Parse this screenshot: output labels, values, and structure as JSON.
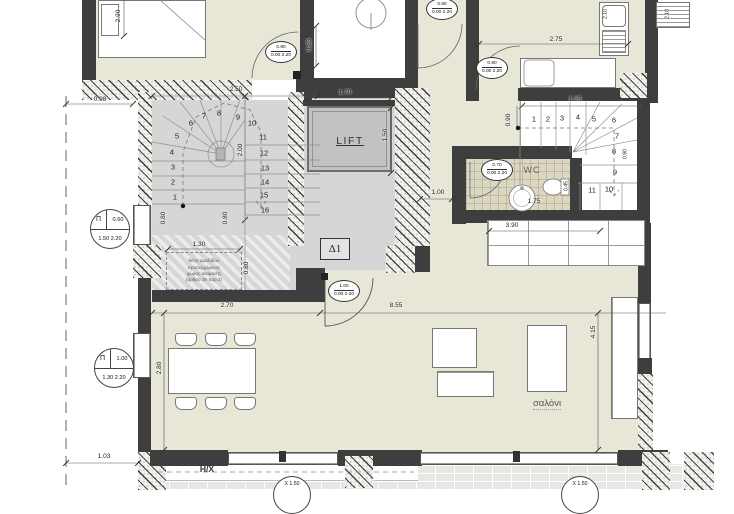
{
  "labels": {
    "lift": "LIFT",
    "wc": "WC",
    "living": "σαλόνι",
    "d1": "Δ1",
    "hx": "Η/Χ",
    "bedroom_partial": "υπνοδωμάτιο"
  },
  "notes": [
    "θέση αμαξιδίου",
    "προσερχόμενος",
    "χώρος αναμονής",
    "(άρθρο 26 παρ.2)"
  ],
  "dims": [
    {
      "t": "0.98",
      "x": 100,
      "y": 100
    },
    {
      "t": "2.90",
      "x": 119,
      "y": 16,
      "r": 1
    },
    {
      "t": "2.50",
      "x": 236,
      "y": 90
    },
    {
      "t": "2.00",
      "x": 241,
      "y": 150,
      "r": 1
    },
    {
      "t": "0.80",
      "x": 164,
      "y": 218,
      "r": 1
    },
    {
      "t": "0.80",
      "x": 226,
      "y": 218,
      "r": 1
    },
    {
      "t": "1.30",
      "x": 199,
      "y": 245
    },
    {
      "t": "0.80",
      "x": 247,
      "y": 268,
      "r": 1
    },
    {
      "t": "1.70",
      "x": 345,
      "y": 93
    },
    {
      "t": "1.50",
      "x": 386,
      "y": 135,
      "r": 1
    },
    {
      "t": "0.85",
      "x": 310,
      "y": 45,
      "r": 1
    },
    {
      "t": "2.75",
      "x": 556,
      "y": 40
    },
    {
      "t": "2.10",
      "x": 606,
      "y": 14,
      "r": 1,
      "s": 1
    },
    {
      "t": "2.10",
      "x": 668,
      "y": 14,
      "r": 1,
      "s": 1
    },
    {
      "t": "1.95",
      "x": 575,
      "y": 100
    },
    {
      "t": "0.90",
      "x": 509,
      "y": 120,
      "r": 1
    },
    {
      "t": "0.90",
      "x": 626,
      "y": 154,
      "r": 1,
      "s": 1
    },
    {
      "t": "1.00",
      "x": 438,
      "y": 193
    },
    {
      "t": "1.75",
      "x": 534,
      "y": 202
    },
    {
      "t": "0.45",
      "x": 567,
      "y": 186,
      "r": 1,
      "s": 1
    },
    {
      "t": "3.90",
      "x": 512,
      "y": 226
    },
    {
      "t": "2.70",
      "x": 227,
      "y": 306
    },
    {
      "t": "8.55",
      "x": 396,
      "y": 306
    },
    {
      "t": "2.80",
      "x": 160,
      "y": 368,
      "r": 1
    },
    {
      "t": "4.15",
      "x": 594,
      "y": 332,
      "r": 1
    },
    {
      "t": "1.03",
      "x": 104,
      "y": 457
    }
  ],
  "door_tags": [
    {
      "w": "0.80",
      "b": "0.00 2.20",
      "x": 281,
      "y": 52
    },
    {
      "w": "0.80",
      "b": "0.00 2.20",
      "x": 442,
      "y": 9
    },
    {
      "w": "0.80",
      "b": "0.00 2.20",
      "x": 492,
      "y": 68
    },
    {
      "w": "1.00",
      "b": "0.00 2.20",
      "x": 344,
      "y": 291
    },
    {
      "w": "0.70",
      "b": "0.00 2.20",
      "x": 497,
      "y": 170
    }
  ],
  "window_tags": [
    {
      "sym": "Π",
      "top": "0.60",
      "bottom": "1.50 2.20",
      "x": 110,
      "y": 229
    },
    {
      "sym": "Π",
      "top": "1.00",
      "bottom": "1.30 2.20",
      "x": 114,
      "y": 368
    }
  ],
  "bottom_tags": [
    {
      "t": "Χ 1.50",
      "x": 292,
      "y": 476
    },
    {
      "t": "Χ 1.50",
      "x": 580,
      "y": 476
    }
  ],
  "stairs": {
    "left": [
      {
        "n": "1",
        "x": 175,
        "y": 197
      },
      {
        "n": "2",
        "x": 173,
        "y": 182
      },
      {
        "n": "3",
        "x": 173,
        "y": 167
      },
      {
        "n": "4",
        "x": 172,
        "y": 152
      },
      {
        "n": "5",
        "x": 177,
        "y": 136
      },
      {
        "n": "6",
        "x": 191,
        "y": 123
      },
      {
        "n": "7",
        "x": 204,
        "y": 116
      },
      {
        "n": "8",
        "x": 219,
        "y": 113
      },
      {
        "n": "9",
        "x": 238,
        "y": 117
      },
      {
        "n": "10",
        "x": 252,
        "y": 123
      },
      {
        "n": "11",
        "x": 263,
        "y": 137
      },
      {
        "n": "12",
        "x": 264,
        "y": 153
      },
      {
        "n": "13",
        "x": 265,
        "y": 168
      },
      {
        "n": "14",
        "x": 265,
        "y": 182
      },
      {
        "n": "15",
        "x": 264,
        "y": 195
      },
      {
        "n": "16",
        "x": 265,
        "y": 210
      }
    ],
    "right": [
      {
        "n": "1",
        "x": 534,
        "y": 119
      },
      {
        "n": "2",
        "x": 548,
        "y": 119
      },
      {
        "n": "3",
        "x": 562,
        "y": 118
      },
      {
        "n": "4",
        "x": 578,
        "y": 117
      },
      {
        "n": "5",
        "x": 594,
        "y": 119
      },
      {
        "n": "6",
        "x": 614,
        "y": 120
      },
      {
        "n": "7",
        "x": 617,
        "y": 136
      },
      {
        "n": "8",
        "x": 614,
        "y": 151
      },
      {
        "n": "9",
        "x": 615,
        "y": 172
      },
      {
        "n": "10",
        "x": 609,
        "y": 189
      },
      {
        "n": "11",
        "x": 592,
        "y": 190
      }
    ]
  },
  "colors": {
    "wall": "#3e3e3e",
    "floor_beige": "#e7e6d7",
    "floor_gray": "#d6d6d6",
    "lift_car": "#c2c2c2"
  }
}
